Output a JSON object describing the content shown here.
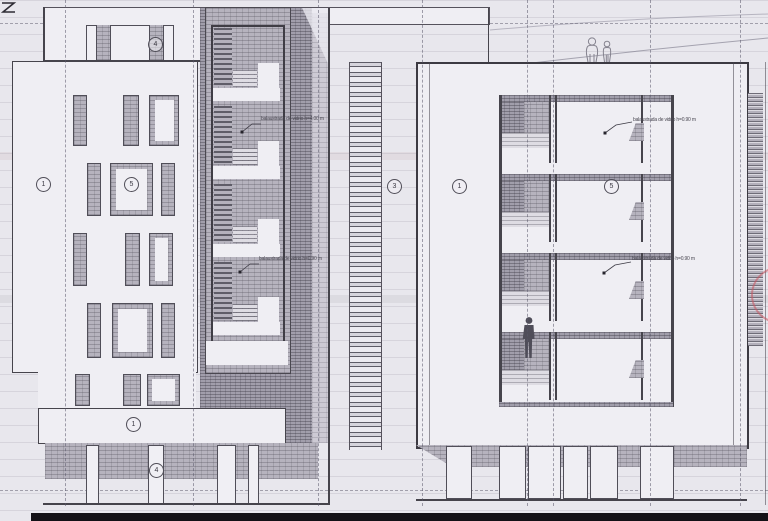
{
  "sheet": {
    "type_label": "building elevation drawing",
    "paper_color": "#e8e7ed",
    "line_color": "#46444c",
    "hatch_color": "#b6b3be",
    "accent_red": "#c6565f",
    "corner_mark": "Z"
  },
  "markers": {
    "left_top": "4",
    "left_wall": "1",
    "left_bay": "5",
    "left_band": "1",
    "left_ground": "4",
    "center": "3",
    "right_wall": "1",
    "right_bay": "5"
  },
  "annotations": {
    "left_upper": "balaustrada de vidrio  h=4.00 m",
    "left_lower": "balaustrada de vidrio  h=0.90 m",
    "right_upper": "balaustrada de vidrio  h=0.90 m",
    "right_lower": "balaustrada de vidrio  h=0.90 m"
  }
}
